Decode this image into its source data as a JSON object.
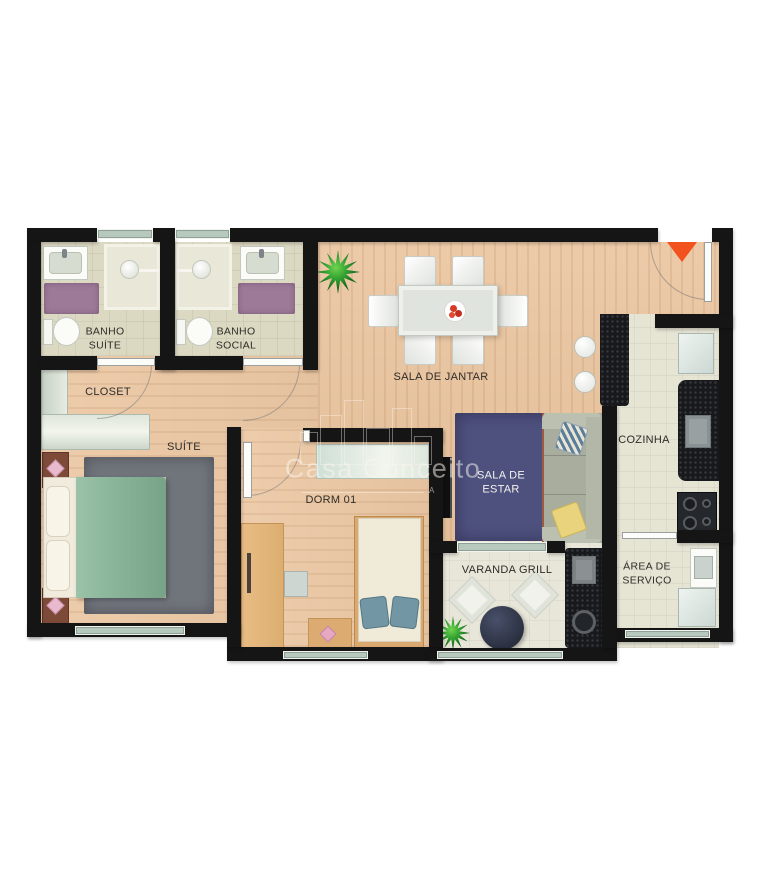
{
  "meta": {
    "type": "apartment-floor-plan",
    "view": "top-down-furnished"
  },
  "watermark": {
    "brand": "Casa Conceito",
    "mark": "A"
  },
  "rooms": {
    "banho_suite": {
      "label": "BANHO\nSUÍTE"
    },
    "banho_social": {
      "label": "BANHO\nSOCIAL"
    },
    "sala_de_jantar": {
      "label": "SALA DE JANTAR"
    },
    "closet": {
      "label": "CLOSET"
    },
    "suite": {
      "label": "SUÍTE"
    },
    "dorm01": {
      "label": "DORM 01"
    },
    "sala_de_estar": {
      "label": "SALA DE\nESTAR"
    },
    "cozinha": {
      "label": "COZINHA"
    },
    "varanda": {
      "label": "VARANDA GRILL"
    },
    "area_servico": {
      "label": "ÁREA DE\nSERVIÇO"
    }
  },
  "palette": {
    "wall": "#151515",
    "wood_floor": "#eac49e",
    "bath_tile": "#dcd9c2",
    "kitchen_tile": "#e6e4d3",
    "rug_bath": "#9c7a98",
    "rug_suite": "#70747b",
    "rug_living": "#4e507e",
    "bed_blanket": "#8cb79c",
    "sofa": "#a9ad9e",
    "granite_counter": "#17191d",
    "window_glass": "#b7c8bd",
    "wood_furniture": "#e0b175",
    "entrance_marker": "#f2521d"
  },
  "icons": {
    "entrance": "orange-triangle-down",
    "plants": "spiky-green-plant",
    "shower": "circle-head-with-arm",
    "stove": "four-burner-cooktop"
  }
}
